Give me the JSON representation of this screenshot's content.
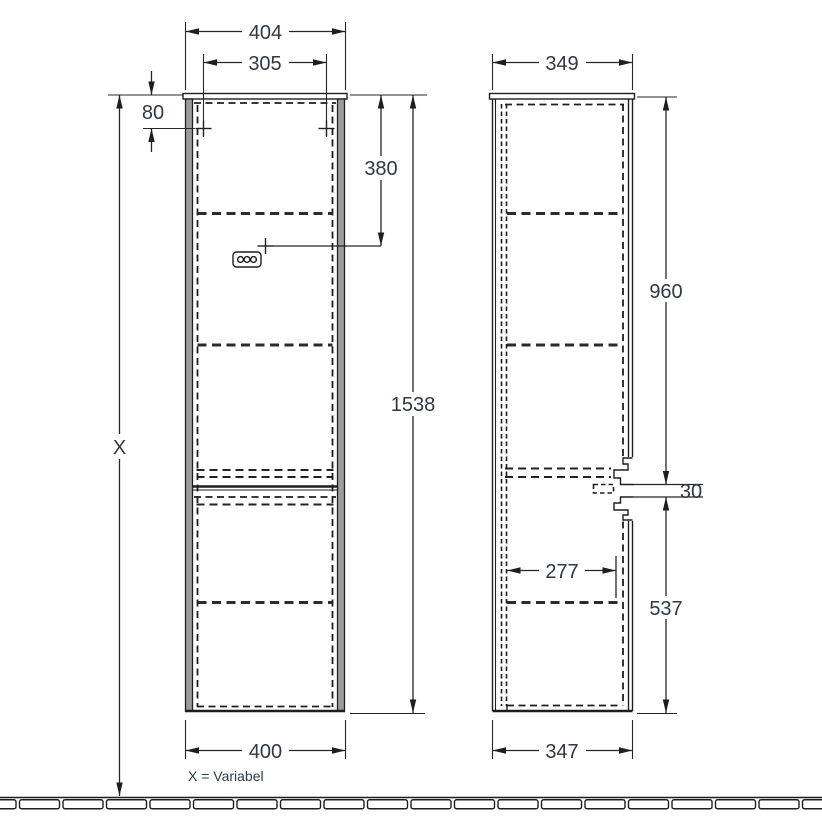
{
  "colors": {
    "line": "#1e1e20",
    "text": "#2f3845",
    "panel_fill": "#9c9c9c",
    "background": "#ffffff"
  },
  "front_view": {
    "width_top": "404",
    "mount_hole_spacing": "305",
    "mount_hole_offset": "80",
    "socket_from_top": "380",
    "cabinet_height": "1538",
    "floor_height": "X",
    "width_bottom": "400",
    "note": "X = Variabel"
  },
  "side_view": {
    "depth_top": "349",
    "upper_section_height": "960",
    "handle_gap": "30",
    "inner_depth": "277",
    "lower_section_height": "537",
    "depth_bottom": "347"
  }
}
